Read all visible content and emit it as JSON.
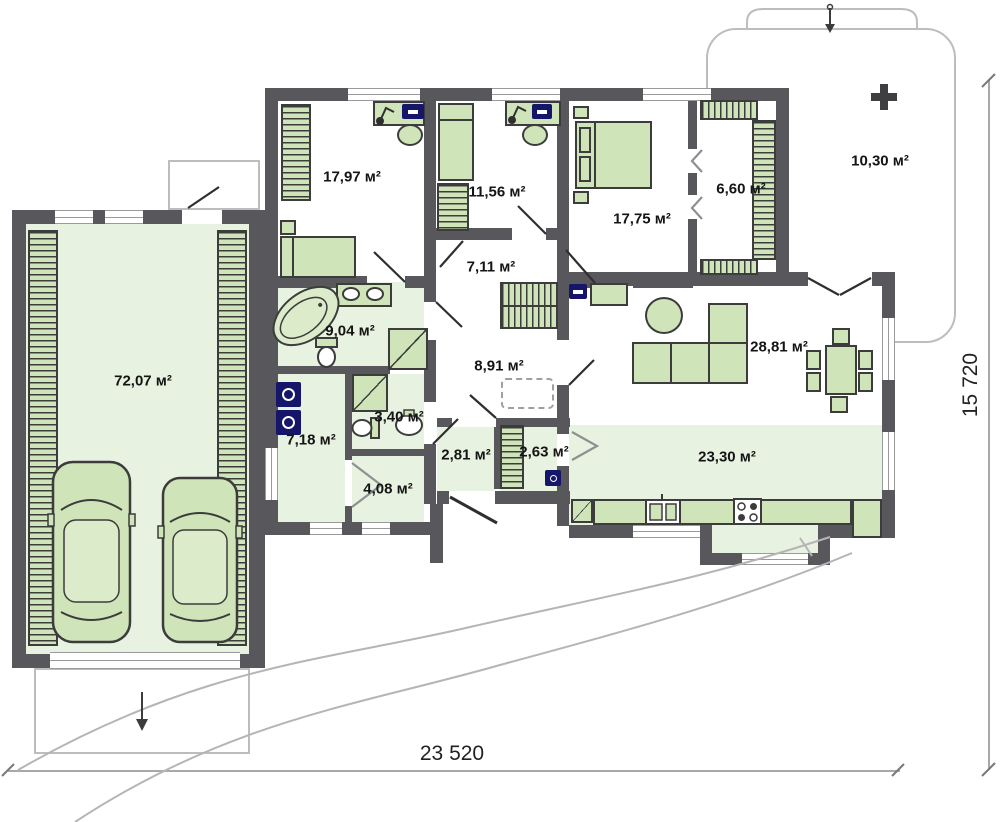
{
  "title": "single-storey house floor plan",
  "units": "м²",
  "rooms": [
    {
      "id": "garage",
      "area": "72,07 м²"
    },
    {
      "id": "bedroom-1",
      "area": "17,97 м²"
    },
    {
      "id": "bedroom-2",
      "area": "11,56 м²"
    },
    {
      "id": "bedroom-3",
      "area": "17,75 м²"
    },
    {
      "id": "walk-in-closet",
      "area": "6,60 м²"
    },
    {
      "id": "terrace",
      "area": "10,30 м²"
    },
    {
      "id": "corridor",
      "area": "7,11 м²"
    },
    {
      "id": "bathroom",
      "area": "9,04 м²"
    },
    {
      "id": "hall",
      "area": "8,91 м²"
    },
    {
      "id": "living-room",
      "area": "28,81 м²"
    },
    {
      "id": "wc",
      "area": "3,40 м²"
    },
    {
      "id": "laundry",
      "area": "7,18 м²"
    },
    {
      "id": "entry-hall",
      "area": "2,81 м²"
    },
    {
      "id": "entry-closet",
      "area": "2,63 м²"
    },
    {
      "id": "hallway",
      "area": "4,08 м²"
    },
    {
      "id": "kitchen-dining",
      "area": "23,30 м²"
    }
  ],
  "dimensions": {
    "overall_width": "23 520",
    "overall_height": "15 720"
  },
  "colors": {
    "wall": "#58585c",
    "room_fill": "#e8f2e1",
    "furniture_fill": "#cfe4b8",
    "appliance_navy": "#151569",
    "outline_gray": "#bdbdbd"
  },
  "icons": [
    "car-icon",
    "bed-icon",
    "desk-icon",
    "computer-icon",
    "desk-lamp-icon",
    "wardrobe-icon",
    "shelving-icon",
    "bathtub-icon",
    "washbasin-icon",
    "toilet-icon",
    "shower-icon",
    "washer-icon",
    "dryer-icon",
    "tv-icon",
    "sofa-icon",
    "coffee-table-icon",
    "dining-table-icon",
    "chair-icon",
    "kitchen-sink-icon",
    "stove-icon",
    "attic-hatch-icon",
    "tree-icon",
    "driveway-arrow-icon",
    "terrace-arrow-icon",
    "walkway-path",
    "door-swing",
    "dimension-line"
  ]
}
